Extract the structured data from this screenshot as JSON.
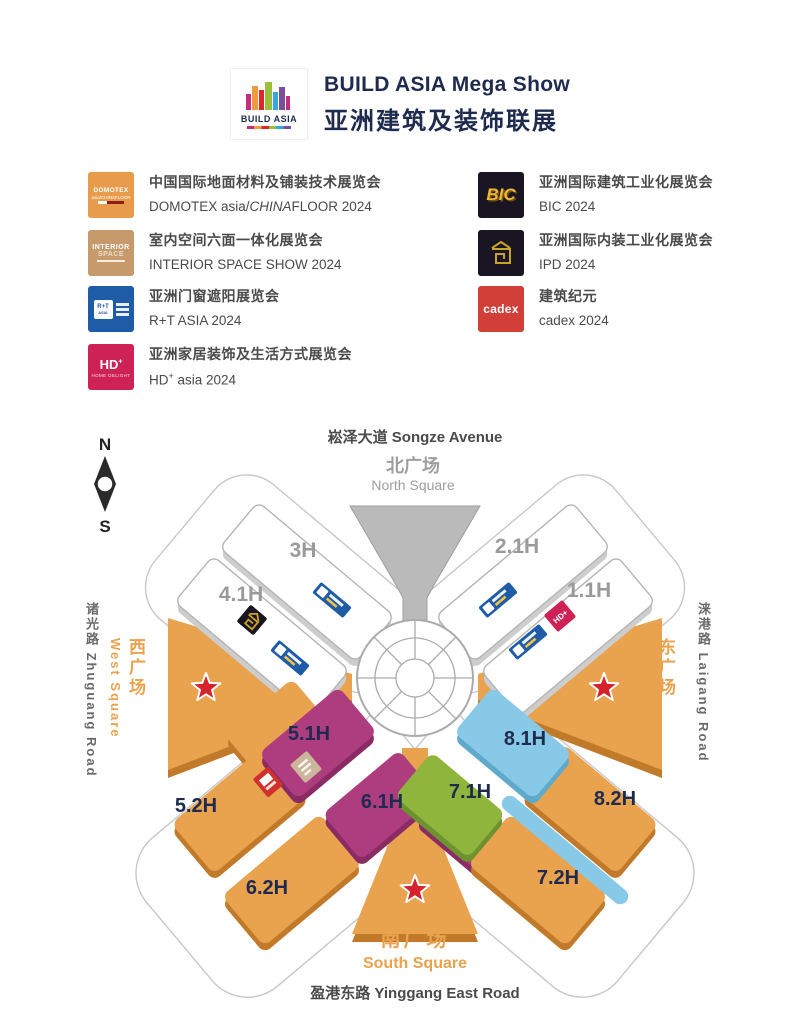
{
  "header": {
    "logo": {
      "label": "BUILD ASIA"
    },
    "title": "BUILD ASIA Mega Show",
    "subtitle": "亚洲建筑及装饰联展"
  },
  "legend": {
    "left": [
      {
        "logo": {
          "type": "domotex",
          "bg": "#E89B4B",
          "line1": "DOMOTEX",
          "line2": "asia/CHINAFLOOR"
        },
        "cn": "中国国际地面材料及铺装技术展览会",
        "en_prefix": "DOMOTEX asia/",
        "en_italic": "CHINA",
        "en_suffix": "FLOOR 2024"
      },
      {
        "logo": {
          "type": "interior",
          "bg": "#C79A6B",
          "line1": "INTERIOR",
          "line2": "SPACE"
        },
        "cn": "室内空间六面一体化展览会",
        "en": "INTERIOR SPACE SHOW 2024"
      },
      {
        "logo": {
          "type": "rt",
          "bg": "#1E5CA8",
          "line1": "R+T",
          "line2": "ASIA"
        },
        "cn": "亚洲门窗遮阳展览会",
        "en": "R+T ASIA 2024"
      },
      {
        "logo": {
          "type": "hd",
          "bg": "#CE2257",
          "line1": "HD",
          "line2": "HOME DELIGHT"
        },
        "cn": "亚洲家居装饰及生活方式展览会",
        "en_prefix": "HD",
        "en_sup": "+",
        "en_suffix": " asia 2024"
      }
    ],
    "right": [
      {
        "logo": {
          "type": "bic",
          "bg": "#1A1523",
          "line1": "BIC"
        },
        "cn": "亚洲国际建筑工业化展览会",
        "en": "BIC 2024"
      },
      {
        "logo": {
          "type": "ipd",
          "bg": "#1A1523"
        },
        "cn": "亚洲国际内装工业化展览会",
        "en": "IPD 2024"
      },
      {
        "logo": {
          "type": "cadex",
          "bg": "#D23F38",
          "line1": "cadex"
        },
        "cn": "建筑纪元",
        "en": "cadex 2024"
      }
    ]
  },
  "map": {
    "roads": {
      "north": "崧泽大道 Songze Avenue",
      "south": "盈港东路 Yinggang East Road",
      "west": "诸光路 Zhuguang Road",
      "east": "涞港路 Laigang Road"
    },
    "squares": {
      "north": {
        "cn": "北广场",
        "en": "North Square"
      },
      "south": {
        "cn": "南广场",
        "en": "South Square"
      },
      "west": {
        "cn": "西广场",
        "en": "West Square"
      },
      "east": {
        "cn": "东广场",
        "en": "East Square"
      }
    },
    "compass": {
      "n": "N",
      "s": "S"
    },
    "colors": {
      "orange": "#E9A24E",
      "orange_shadow": "#C17A2A",
      "magenta": "#AD3D7F",
      "magenta_shadow": "#8A2B63",
      "blue": "#87C9E7",
      "blue_shadow": "#5FA9CD",
      "green": "#8FB53C",
      "green_shadow": "#6E9230",
      "white_hall": "#FFFFFF",
      "white_hall_shadow": "#CDCDCD",
      "gray_funnel": "#BABABA",
      "star_red": "#D6222B",
      "label_navy": "#1E2B4F",
      "label_gray": "#9A9A9A",
      "square_text": "#E9A24E",
      "road_text": "#4A4A4A"
    },
    "shapes": [
      {
        "id": "3H",
        "label": "3H",
        "cx": 307,
        "cy": 162,
        "angle": 40,
        "length": 178,
        "width": 60,
        "fill": "#FFFFFF",
        "stroke": "#B5B5B5",
        "shadow": "#CDCDCD",
        "label_color": "#9A9A9A",
        "lx": 303,
        "ly": 137,
        "label_size": 21
      },
      {
        "id": "4.1H",
        "label": "4.1H",
        "cx": 262,
        "cy": 216,
        "angle": 40,
        "length": 178,
        "width": 60,
        "fill": "#FFFFFF",
        "stroke": "#B5B5B5",
        "shadow": "#CDCDCD",
        "label_color": "#9A9A9A",
        "lx": 241,
        "ly": 181,
        "label_size": 21
      },
      {
        "id": "2.1H",
        "label": "2.1H",
        "cx": 523,
        "cy": 162,
        "angle": -40,
        "length": 178,
        "width": 60,
        "fill": "#FFFFFF",
        "stroke": "#B5B5B5",
        "shadow": "#CDCDCD",
        "label_color": "#9A9A9A",
        "lx": 517,
        "ly": 133,
        "label_size": 21
      },
      {
        "id": "1.1H",
        "label": "1.1H",
        "cx": 568,
        "cy": 216,
        "angle": -40,
        "length": 178,
        "width": 60,
        "fill": "#FFFFFF",
        "stroke": "#B5B5B5",
        "shadow": "#CDCDCD",
        "label_color": "#9A9A9A",
        "lx": 589,
        "ly": 177,
        "label_size": 21
      },
      {
        "cx": 272,
        "cy": 303,
        "angle": -40,
        "length": 88,
        "width": 42,
        "fill": "#E9A24E",
        "shadow": "#C17A2A"
      },
      {
        "id": "5.2H",
        "label": "5.2H",
        "cx": 240,
        "cy": 389,
        "angle": -40,
        "length": 124,
        "width": 66,
        "fill": "#E9A24E",
        "shadow": "#C17A2A",
        "label_color": "#1E2B4F",
        "lx": 196,
        "ly": 392,
        "label_size": 20
      },
      {
        "id": "5.1H",
        "label": "5.1H",
        "cx": 318,
        "cy": 323,
        "angle": -40,
        "length": 104,
        "width": 60,
        "fill": "#AD3D7F",
        "shadow": "#8A2B63",
        "label_color": "#1E2B4F",
        "lx": 309,
        "ly": 320,
        "label_size": 20
      },
      {
        "id": "6.2H",
        "label": "6.2H",
        "cx": 292,
        "cy": 460,
        "angle": -40,
        "length": 128,
        "width": 66,
        "fill": "#E9A24E",
        "shadow": "#C17A2A",
        "label_color": "#1E2B4F",
        "lx": 267,
        "ly": 474,
        "label_size": 20
      },
      {
        "id": "6.1H",
        "label": "6.1H",
        "cx": 380,
        "cy": 385,
        "angle": -40,
        "length": 100,
        "width": 60,
        "fill": "#AD3D7F",
        "shadow": "#8A2B63",
        "label_color": "#1E2B4F",
        "lx": 382,
        "ly": 388,
        "label_size": 20
      },
      {
        "cx": 470,
        "cy": 428,
        "angle": 40,
        "length": 120,
        "width": 26,
        "fill": "#AD3D7F",
        "shadow": "#8A2B63"
      },
      {
        "id": "7.2H",
        "label": "7.2H",
        "cx": 538,
        "cy": 460,
        "angle": 40,
        "length": 128,
        "width": 66,
        "fill": "#E9A24E",
        "shadow": "#C17A2A",
        "label_color": "#1E2B4F",
        "lx": 558,
        "ly": 464,
        "label_size": 20
      },
      {
        "id": "7.1H",
        "label": "7.1H",
        "cx": 450,
        "cy": 385,
        "angle": 40,
        "length": 96,
        "width": 58,
        "fill": "#8FB53C",
        "shadow": "#6E9230",
        "label_color": "#1E2B4F",
        "lx": 470,
        "ly": 378,
        "label_size": 20
      },
      {
        "cx": 565,
        "cy": 430,
        "angle": 40,
        "length": 160,
        "width": 16,
        "fill": "#87C9E7"
      },
      {
        "id": "8.2H",
        "label": "8.2H",
        "cx": 590,
        "cy": 389,
        "angle": 40,
        "length": 124,
        "width": 66,
        "fill": "#E9A24E",
        "shadow": "#C17A2A",
        "label_color": "#1E2B4F",
        "lx": 615,
        "ly": 385,
        "label_size": 20
      },
      {
        "id": "8.1H",
        "label": "8.1H",
        "cx": 513,
        "cy": 323,
        "angle": 40,
        "length": 104,
        "width": 60,
        "fill": "#87C9E7",
        "shadow": "#5FA9CD",
        "label_color": "#1E2B4F",
        "lx": 525,
        "ly": 325,
        "label_size": 20
      }
    ],
    "logos": [
      {
        "type": "rt",
        "x": 332,
        "y": 180,
        "angle": 40
      },
      {
        "type": "ipd",
        "x": 252,
        "y": 200,
        "angle": 40
      },
      {
        "type": "rt",
        "x": 290,
        "y": 238,
        "angle": 40
      },
      {
        "type": "rt",
        "x": 498,
        "y": 180,
        "angle": -40
      },
      {
        "type": "hd",
        "x": 560,
        "y": 196,
        "angle": -40
      },
      {
        "type": "rt",
        "x": 528,
        "y": 222,
        "angle": -40
      },
      {
        "type": "domotex",
        "x": 268,
        "y": 362,
        "angle": -40
      },
      {
        "type": "interior",
        "x": 306,
        "y": 347,
        "angle": -40
      }
    ]
  }
}
